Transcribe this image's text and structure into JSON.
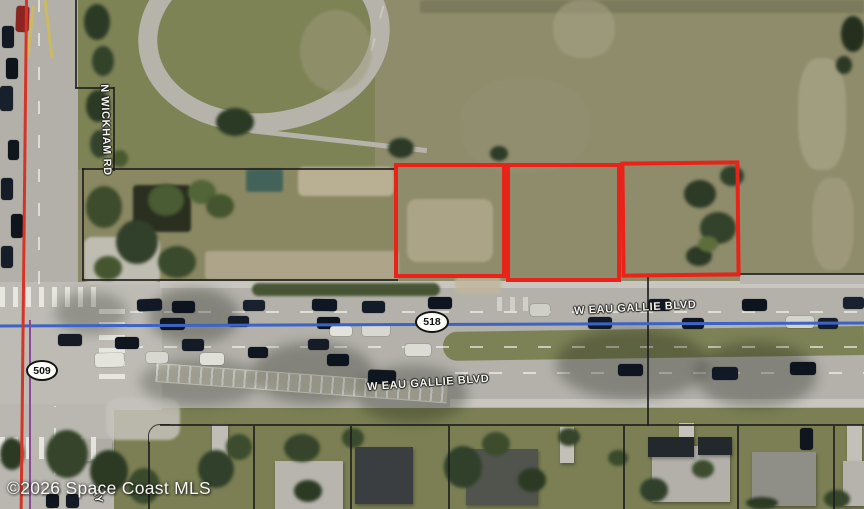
{
  "map": {
    "copyright": "©2026 Space Coast MLS",
    "road_labels": {
      "n_wickham": "N WICKHAM RD",
      "eau_gallie_east": "W EAU GALLIE BLVD",
      "eau_gallie_west": "W EAU GALLIE BLVD",
      "partial_street": "AY"
    },
    "route_shields": {
      "sr518": "518",
      "sr509": "509"
    },
    "colors": {
      "parcel_outline_red": "#e8231a",
      "route_line_blue": "#3c63c6",
      "route_line_red": "#d63426",
      "route_line_purple": "#8a4a99",
      "boundary_line_black": "#1d1d1d",
      "label_text": "#f4f4ee"
    }
  },
  "decor": [
    {
      "k": "patch",
      "x": 420,
      "y": 0,
      "w": 444,
      "h": 13,
      "c": "#757457",
      "o": 0.75
    },
    {
      "k": "patch",
      "x": 300,
      "y": 10,
      "w": 72,
      "h": 82,
      "c": "#9e9c7b",
      "o": 0.5,
      "b": "50%"
    },
    {
      "k": "patch",
      "x": 553,
      "y": 0,
      "w": 62,
      "h": 58,
      "c": "#aaa489",
      "o": 0.5,
      "b": "45%"
    },
    {
      "k": "patch",
      "x": 798,
      "y": 58,
      "w": 48,
      "h": 112,
      "c": "#b2ab91",
      "o": 0.55,
      "b": "40%"
    },
    {
      "k": "patch",
      "x": 812,
      "y": 178,
      "w": 42,
      "h": 92,
      "c": "#aea78c",
      "o": 0.45,
      "b": "40%"
    },
    {
      "k": "patch",
      "x": 460,
      "y": 78,
      "w": 130,
      "h": 95,
      "c": "#97947a",
      "o": 0.3,
      "b": "45%"
    },
    {
      "k": "patch",
      "x": 407,
      "y": 199,
      "w": 86,
      "h": 63,
      "c": "#b2a98c",
      "o": 0.85,
      "b": "10px"
    },
    {
      "k": "patch",
      "x": 298,
      "y": 167,
      "w": 96,
      "h": 29,
      "c": "#c2b89d",
      "o": 0.85,
      "b": "6px"
    },
    {
      "k": "patch",
      "x": 205,
      "y": 251,
      "w": 194,
      "h": 29,
      "c": "#b1a88f",
      "o": 0.9,
      "b": "4px"
    },
    {
      "k": "patch",
      "x": 455,
      "y": 277,
      "w": 46,
      "h": 17,
      "c": "#c0b69b",
      "o": 0.8,
      "b": "4px"
    },
    {
      "k": "patch",
      "x": 84,
      "y": 237,
      "w": 76,
      "h": 47,
      "c": "#c5c3ba",
      "o": 0.9,
      "b": "8px"
    },
    {
      "k": "patch",
      "x": 106,
      "y": 398,
      "w": 74,
      "h": 42,
      "c": "#c5c3ba",
      "o": 0.85,
      "b": "12px"
    },
    {
      "k": "patch",
      "x": 252,
      "y": 283,
      "w": 188,
      "h": 13,
      "c": "#3e4d2b",
      "o": 0.92,
      "b": "7px"
    },
    {
      "k": "patch",
      "x": 133,
      "y": 185,
      "w": 58,
      "h": 47,
      "c": "#22281b",
      "o": 0.92,
      "b": "4px"
    },
    {
      "k": "patch",
      "x": 246,
      "y": 169,
      "w": 37,
      "h": 23,
      "c": "#40625a",
      "o": 0.95,
      "b": "3px"
    },
    {
      "k": "shadow",
      "x": 148,
      "y": 288,
      "w": 92,
      "h": 56,
      "c": "#161c10",
      "o": 0.3
    },
    {
      "k": "shadow",
      "x": 252,
      "y": 342,
      "w": 122,
      "h": 62,
      "c": "#161c10",
      "o": 0.3
    },
    {
      "k": "shadow",
      "x": 356,
      "y": 365,
      "w": 112,
      "h": 58,
      "c": "#161c10",
      "o": 0.28
    },
    {
      "k": "shadow",
      "x": 556,
      "y": 328,
      "w": 152,
      "h": 72,
      "c": "#161c10",
      "o": 0.3
    },
    {
      "k": "shadow",
      "x": 695,
      "y": 342,
      "w": 122,
      "h": 66,
      "c": "#161c10",
      "o": 0.3
    },
    {
      "k": "shadow",
      "x": 55,
      "y": 292,
      "w": 72,
      "h": 42,
      "c": "#161c10",
      "o": 0.25
    },
    {
      "k": "shadow",
      "x": 140,
      "y": 358,
      "w": 120,
      "h": 48,
      "c": "#161c10",
      "o": 0.25
    },
    {
      "k": "tree",
      "x": 84,
      "y": 4,
      "w": 26,
      "h": 36,
      "c": "#2b3a25"
    },
    {
      "k": "tree",
      "x": 92,
      "y": 46,
      "w": 22,
      "h": 30,
      "c": "#33432a"
    },
    {
      "k": "tree",
      "x": 86,
      "y": 90,
      "w": 24,
      "h": 32,
      "c": "#2b3a25"
    },
    {
      "k": "tree",
      "x": 90,
      "y": 130,
      "w": 20,
      "h": 28,
      "c": "#34432c"
    },
    {
      "k": "tree",
      "x": 112,
      "y": 150,
      "w": 16,
      "h": 17,
      "c": "#49582f"
    },
    {
      "k": "tree",
      "x": 216,
      "y": 108,
      "w": 38,
      "h": 28,
      "c": "#2b3a24"
    },
    {
      "k": "tree",
      "x": 388,
      "y": 138,
      "w": 26,
      "h": 20,
      "c": "#2c3a26"
    },
    {
      "k": "tree",
      "x": 490,
      "y": 146,
      "w": 18,
      "h": 15,
      "c": "#2d3b27"
    },
    {
      "k": "tree",
      "x": 86,
      "y": 186,
      "w": 36,
      "h": 42,
      "c": "#3c4c2c"
    },
    {
      "k": "tree",
      "x": 116,
      "y": 220,
      "w": 42,
      "h": 44,
      "c": "#31402a"
    },
    {
      "k": "tree",
      "x": 148,
      "y": 184,
      "w": 36,
      "h": 32,
      "c": "#4a5c34"
    },
    {
      "k": "tree",
      "x": 158,
      "y": 246,
      "w": 38,
      "h": 32,
      "c": "#3a4a2c"
    },
    {
      "k": "tree",
      "x": 94,
      "y": 256,
      "w": 28,
      "h": 24,
      "c": "#45562f"
    },
    {
      "k": "tree",
      "x": 188,
      "y": 180,
      "w": 28,
      "h": 24,
      "c": "#516538"
    },
    {
      "k": "tree",
      "x": 206,
      "y": 194,
      "w": 28,
      "h": 24,
      "c": "#44552f"
    },
    {
      "k": "tree",
      "x": 684,
      "y": 180,
      "w": 32,
      "h": 28,
      "c": "#2c3a26"
    },
    {
      "k": "tree",
      "x": 700,
      "y": 212,
      "w": 36,
      "h": 32,
      "c": "#33422a"
    },
    {
      "k": "tree",
      "x": 686,
      "y": 246,
      "w": 26,
      "h": 20,
      "c": "#2c3a26"
    },
    {
      "k": "tree",
      "x": 720,
      "y": 166,
      "w": 24,
      "h": 20,
      "c": "#31402a"
    },
    {
      "k": "tree",
      "x": 698,
      "y": 236,
      "w": 20,
      "h": 16,
      "c": "#5d6d3c"
    },
    {
      "k": "tree",
      "x": 841,
      "y": 16,
      "w": 24,
      "h": 36,
      "c": "#242f1e"
    },
    {
      "k": "tree",
      "x": 836,
      "y": 56,
      "w": 16,
      "h": 18,
      "c": "#2c3a25"
    },
    {
      "k": "tree",
      "x": 46,
      "y": 430,
      "w": 42,
      "h": 48,
      "c": "#35442a"
    },
    {
      "k": "tree",
      "x": 90,
      "y": 450,
      "w": 38,
      "h": 42,
      "c": "#2c3a24"
    },
    {
      "k": "tree",
      "x": 128,
      "y": 468,
      "w": 32,
      "h": 36,
      "c": "#3a4a2c"
    },
    {
      "k": "tree",
      "x": 0,
      "y": 438,
      "w": 24,
      "h": 32,
      "c": "#2c3a24"
    },
    {
      "k": "tree",
      "x": 198,
      "y": 450,
      "w": 36,
      "h": 38,
      "c": "#31402a"
    },
    {
      "k": "tree",
      "x": 226,
      "y": 434,
      "w": 26,
      "h": 26,
      "c": "#3c4c2c"
    },
    {
      "k": "tree",
      "x": 284,
      "y": 434,
      "w": 36,
      "h": 28,
      "c": "#35442a"
    },
    {
      "k": "tree",
      "x": 294,
      "y": 480,
      "w": 28,
      "h": 22,
      "c": "#2c3a24"
    },
    {
      "k": "tree",
      "x": 342,
      "y": 428,
      "w": 22,
      "h": 20,
      "c": "#3a4a2c"
    },
    {
      "k": "tree",
      "x": 444,
      "y": 446,
      "w": 38,
      "h": 42,
      "c": "#31402a"
    },
    {
      "k": "tree",
      "x": 482,
      "y": 432,
      "w": 28,
      "h": 24,
      "c": "#3c4c2c"
    },
    {
      "k": "tree",
      "x": 518,
      "y": 468,
      "w": 28,
      "h": 24,
      "c": "#2c3a24"
    },
    {
      "k": "tree",
      "x": 558,
      "y": 428,
      "w": 22,
      "h": 18,
      "c": "#35442a"
    },
    {
      "k": "tree",
      "x": 640,
      "y": 478,
      "w": 28,
      "h": 24,
      "c": "#31402a"
    },
    {
      "k": "tree",
      "x": 692,
      "y": 460,
      "w": 22,
      "h": 18,
      "c": "#3c4c2c"
    },
    {
      "k": "tree",
      "x": 746,
      "y": 497,
      "w": 32,
      "h": 12,
      "c": "#2c3a24"
    },
    {
      "k": "tree",
      "x": 824,
      "y": 490,
      "w": 26,
      "h": 18,
      "c": "#35442a"
    },
    {
      "k": "tree",
      "x": 608,
      "y": 450,
      "w": 20,
      "h": 16,
      "c": "#3a4a2c"
    },
    {
      "k": "veh",
      "x": 16,
      "y": 6,
      "w": 13,
      "h": 26,
      "c": "#8c2420",
      "r": 2
    },
    {
      "k": "veh",
      "x": 2,
      "y": 26,
      "w": 12,
      "h": 22,
      "c": "#131a24"
    },
    {
      "k": "veh",
      "x": 6,
      "y": 58,
      "w": 12,
      "h": 21,
      "c": "#0e141c"
    },
    {
      "k": "veh",
      "x": 0,
      "y": 86,
      "w": 13,
      "h": 25,
      "c": "#18202b"
    },
    {
      "k": "veh",
      "x": 8,
      "y": 140,
      "w": 11,
      "h": 20,
      "c": "#10161e"
    },
    {
      "k": "veh",
      "x": 1,
      "y": 178,
      "w": 12,
      "h": 22,
      "c": "#151c26"
    },
    {
      "k": "veh",
      "x": 11,
      "y": 214,
      "w": 12,
      "h": 24,
      "c": "#0f151d"
    },
    {
      "k": "veh",
      "x": 1,
      "y": 246,
      "w": 12,
      "h": 22,
      "c": "#161e28"
    },
    {
      "k": "veh",
      "x": 58,
      "y": 334,
      "w": 24,
      "h": 12,
      "c": "#141b25"
    },
    {
      "k": "veh",
      "x": 46,
      "y": 494,
      "w": 13,
      "h": 14,
      "c": "#10161e"
    },
    {
      "k": "veh",
      "x": 66,
      "y": 494,
      "w": 13,
      "h": 14,
      "c": "#141b25"
    },
    {
      "k": "veh",
      "x": 137,
      "y": 299,
      "w": 25,
      "h": 12,
      "c": "#121926",
      "r": -2
    },
    {
      "k": "veh",
      "x": 172,
      "y": 301,
      "w": 23,
      "h": 12,
      "c": "#0e141e"
    },
    {
      "k": "veh",
      "x": 243,
      "y": 300,
      "w": 22,
      "h": 11,
      "c": "#19212e"
    },
    {
      "k": "veh",
      "x": 312,
      "y": 299,
      "w": 25,
      "h": 12,
      "c": "#101724",
      "r": 1
    },
    {
      "k": "veh",
      "x": 362,
      "y": 301,
      "w": 23,
      "h": 12,
      "c": "#141b28"
    },
    {
      "k": "veh",
      "x": 428,
      "y": 297,
      "w": 24,
      "h": 12,
      "c": "#0f1520"
    },
    {
      "k": "veh",
      "x": 530,
      "y": 304,
      "w": 20,
      "h": 12,
      "c": "#cfcfc8"
    },
    {
      "k": "veh",
      "x": 648,
      "y": 299,
      "w": 23,
      "h": 12,
      "c": "#121926"
    },
    {
      "k": "veh",
      "x": 742,
      "y": 299,
      "w": 25,
      "h": 12,
      "c": "#0e141e"
    },
    {
      "k": "veh",
      "x": 843,
      "y": 297,
      "w": 21,
      "h": 12,
      "c": "#19212e"
    },
    {
      "k": "veh",
      "x": 160,
      "y": 318,
      "w": 25,
      "h": 12,
      "c": "#10161f"
    },
    {
      "k": "veh",
      "x": 228,
      "y": 316,
      "w": 21,
      "h": 11,
      "c": "#151c28"
    },
    {
      "k": "veh",
      "x": 317,
      "y": 317,
      "w": 23,
      "h": 12,
      "c": "#0e141e"
    },
    {
      "k": "veh",
      "x": 330,
      "y": 326,
      "w": 22,
      "h": 10,
      "c": "#e3e3dc"
    },
    {
      "k": "veh",
      "x": 362,
      "y": 324,
      "w": 28,
      "h": 12,
      "c": "#d8d8d0"
    },
    {
      "k": "veh",
      "x": 588,
      "y": 317,
      "w": 24,
      "h": 12,
      "c": "#121a28"
    },
    {
      "k": "veh",
      "x": 682,
      "y": 318,
      "w": 22,
      "h": 11,
      "c": "#10161f"
    },
    {
      "k": "veh",
      "x": 786,
      "y": 316,
      "w": 28,
      "h": 12,
      "c": "#d5d5cd"
    },
    {
      "k": "veh",
      "x": 818,
      "y": 318,
      "w": 20,
      "h": 11,
      "c": "#161d2a"
    },
    {
      "k": "veh",
      "x": 115,
      "y": 337,
      "w": 24,
      "h": 12,
      "c": "#10161f"
    },
    {
      "k": "veh",
      "x": 95,
      "y": 353,
      "w": 29,
      "h": 14,
      "c": "#e4e4dd",
      "r": -1
    },
    {
      "k": "veh",
      "x": 146,
      "y": 352,
      "w": 22,
      "h": 11,
      "c": "#d8d8d1"
    },
    {
      "k": "veh",
      "x": 182,
      "y": 339,
      "w": 22,
      "h": 12,
      "c": "#141b26"
    },
    {
      "k": "veh",
      "x": 200,
      "y": 353,
      "w": 24,
      "h": 12,
      "c": "#e0e0d9"
    },
    {
      "k": "veh",
      "x": 248,
      "y": 347,
      "w": 20,
      "h": 11,
      "c": "#10161f"
    },
    {
      "k": "veh",
      "x": 308,
      "y": 339,
      "w": 21,
      "h": 11,
      "c": "#151c28"
    },
    {
      "k": "veh",
      "x": 327,
      "y": 354,
      "w": 22,
      "h": 12,
      "c": "#0e141e"
    },
    {
      "k": "veh",
      "x": 368,
      "y": 370,
      "w": 28,
      "h": 14,
      "c": "#10161f",
      "r": 2
    },
    {
      "k": "veh",
      "x": 405,
      "y": 344,
      "w": 26,
      "h": 12,
      "c": "#dcdcd5"
    },
    {
      "k": "veh",
      "x": 618,
      "y": 364,
      "w": 25,
      "h": 12,
      "c": "#0f1520"
    },
    {
      "k": "veh",
      "x": 712,
      "y": 367,
      "w": 26,
      "h": 13,
      "c": "#121926"
    },
    {
      "k": "veh",
      "x": 790,
      "y": 362,
      "w": 26,
      "h": 13,
      "c": "#0e141e"
    },
    {
      "k": "veh",
      "x": 800,
      "y": 428,
      "w": 13,
      "h": 22,
      "c": "#10161e"
    }
  ]
}
